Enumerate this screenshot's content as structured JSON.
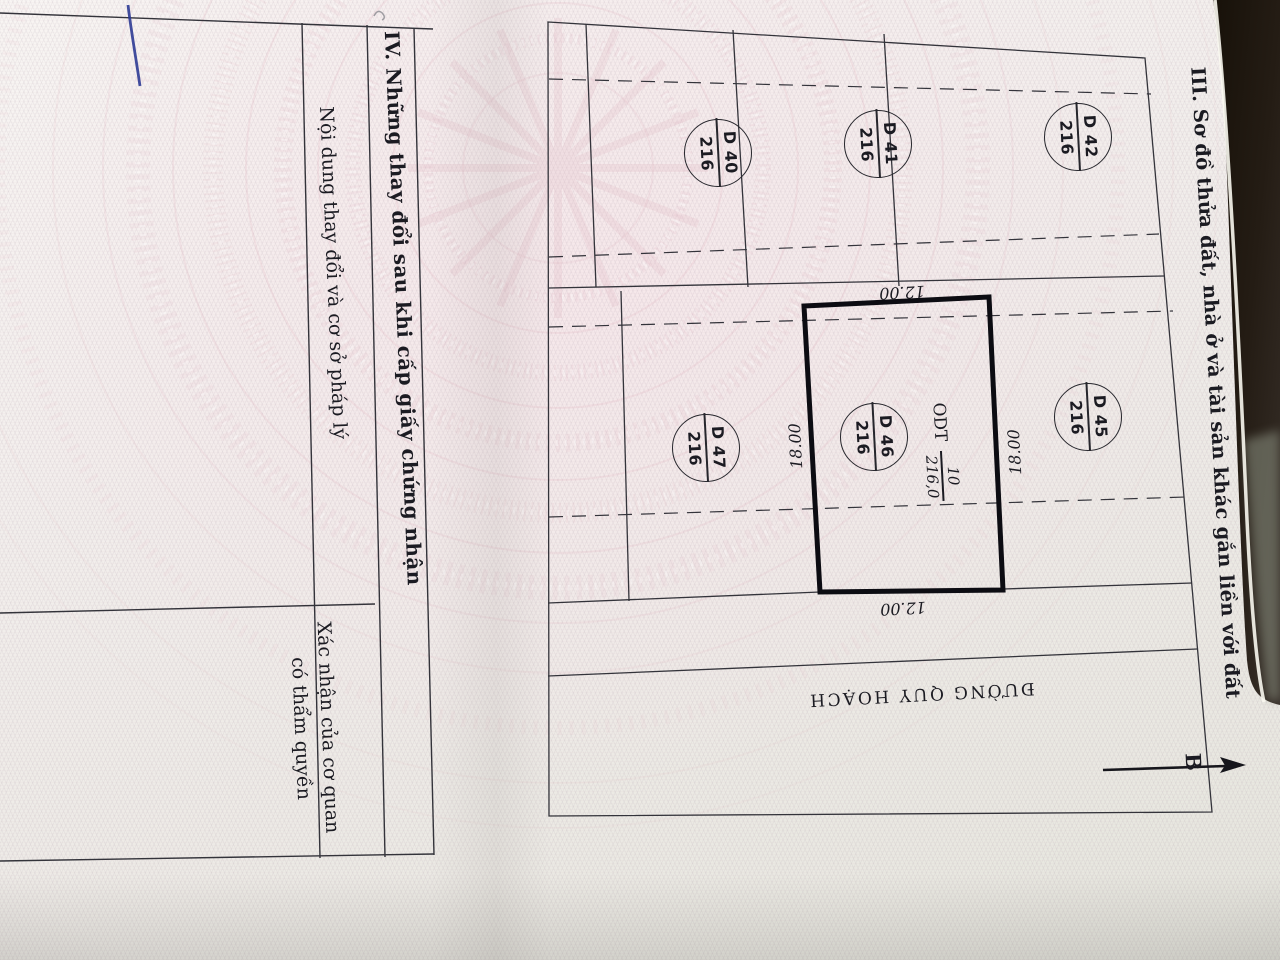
{
  "certificate": {
    "section3": {
      "title": "III. Sơ đồ thửa đất, nhà ở và tài sản khác gắn liền với đất",
      "map": {
        "plots": [
          {
            "code": "D 40",
            "area": "216",
            "x": 718,
            "y": 153
          },
          {
            "code": "D 41",
            "area": "216",
            "x": 878,
            "y": 144
          },
          {
            "code": "D 42",
            "area": "216",
            "x": 1078,
            "y": 137
          },
          {
            "code": "D 45",
            "area": "216",
            "x": 1088,
            "y": 417
          },
          {
            "code": "D 46",
            "area": "216",
            "x": 874,
            "y": 437
          },
          {
            "code": "D 47",
            "area": "216",
            "x": 706,
            "y": 448
          }
        ],
        "focus_plot": {
          "land_use_code": "ODT",
          "plot_number": "10",
          "area": "216,0"
        },
        "dimensions": [
          {
            "value": "12.00",
            "x": 902,
            "y": 291,
            "rot": "rot177"
          },
          {
            "value": "12.00",
            "x": 903,
            "y": 607,
            "rot": "rot177"
          },
          {
            "value": "18.00",
            "x": 797,
            "y": 446,
            "rot": "rotm93"
          },
          {
            "value": "18.00",
            "x": 1016,
            "y": 452,
            "rot": "rotm93"
          }
        ],
        "road_label": "ĐƯỜNG QUY HOẠCH",
        "north_label": "B"
      }
    },
    "section4": {
      "title": "IV. Những thay đổi sau khi cấp giấy chứng nhận",
      "col_content": "Nội dung thay đổi và cơ sở pháp lý",
      "col_confirm_line1": "Xác nhận của cơ quan",
      "col_confirm_line2": "có thẩm quyền"
    }
  },
  "colors": {
    "paper": "#f3efed",
    "guilloche_pink": "#dba9b6",
    "ink": "#1b1b22",
    "bold_parcel_line": "#0c0c12",
    "pen_mark_blue": "#2c3a94",
    "backdrop_dark": "#221a14"
  }
}
